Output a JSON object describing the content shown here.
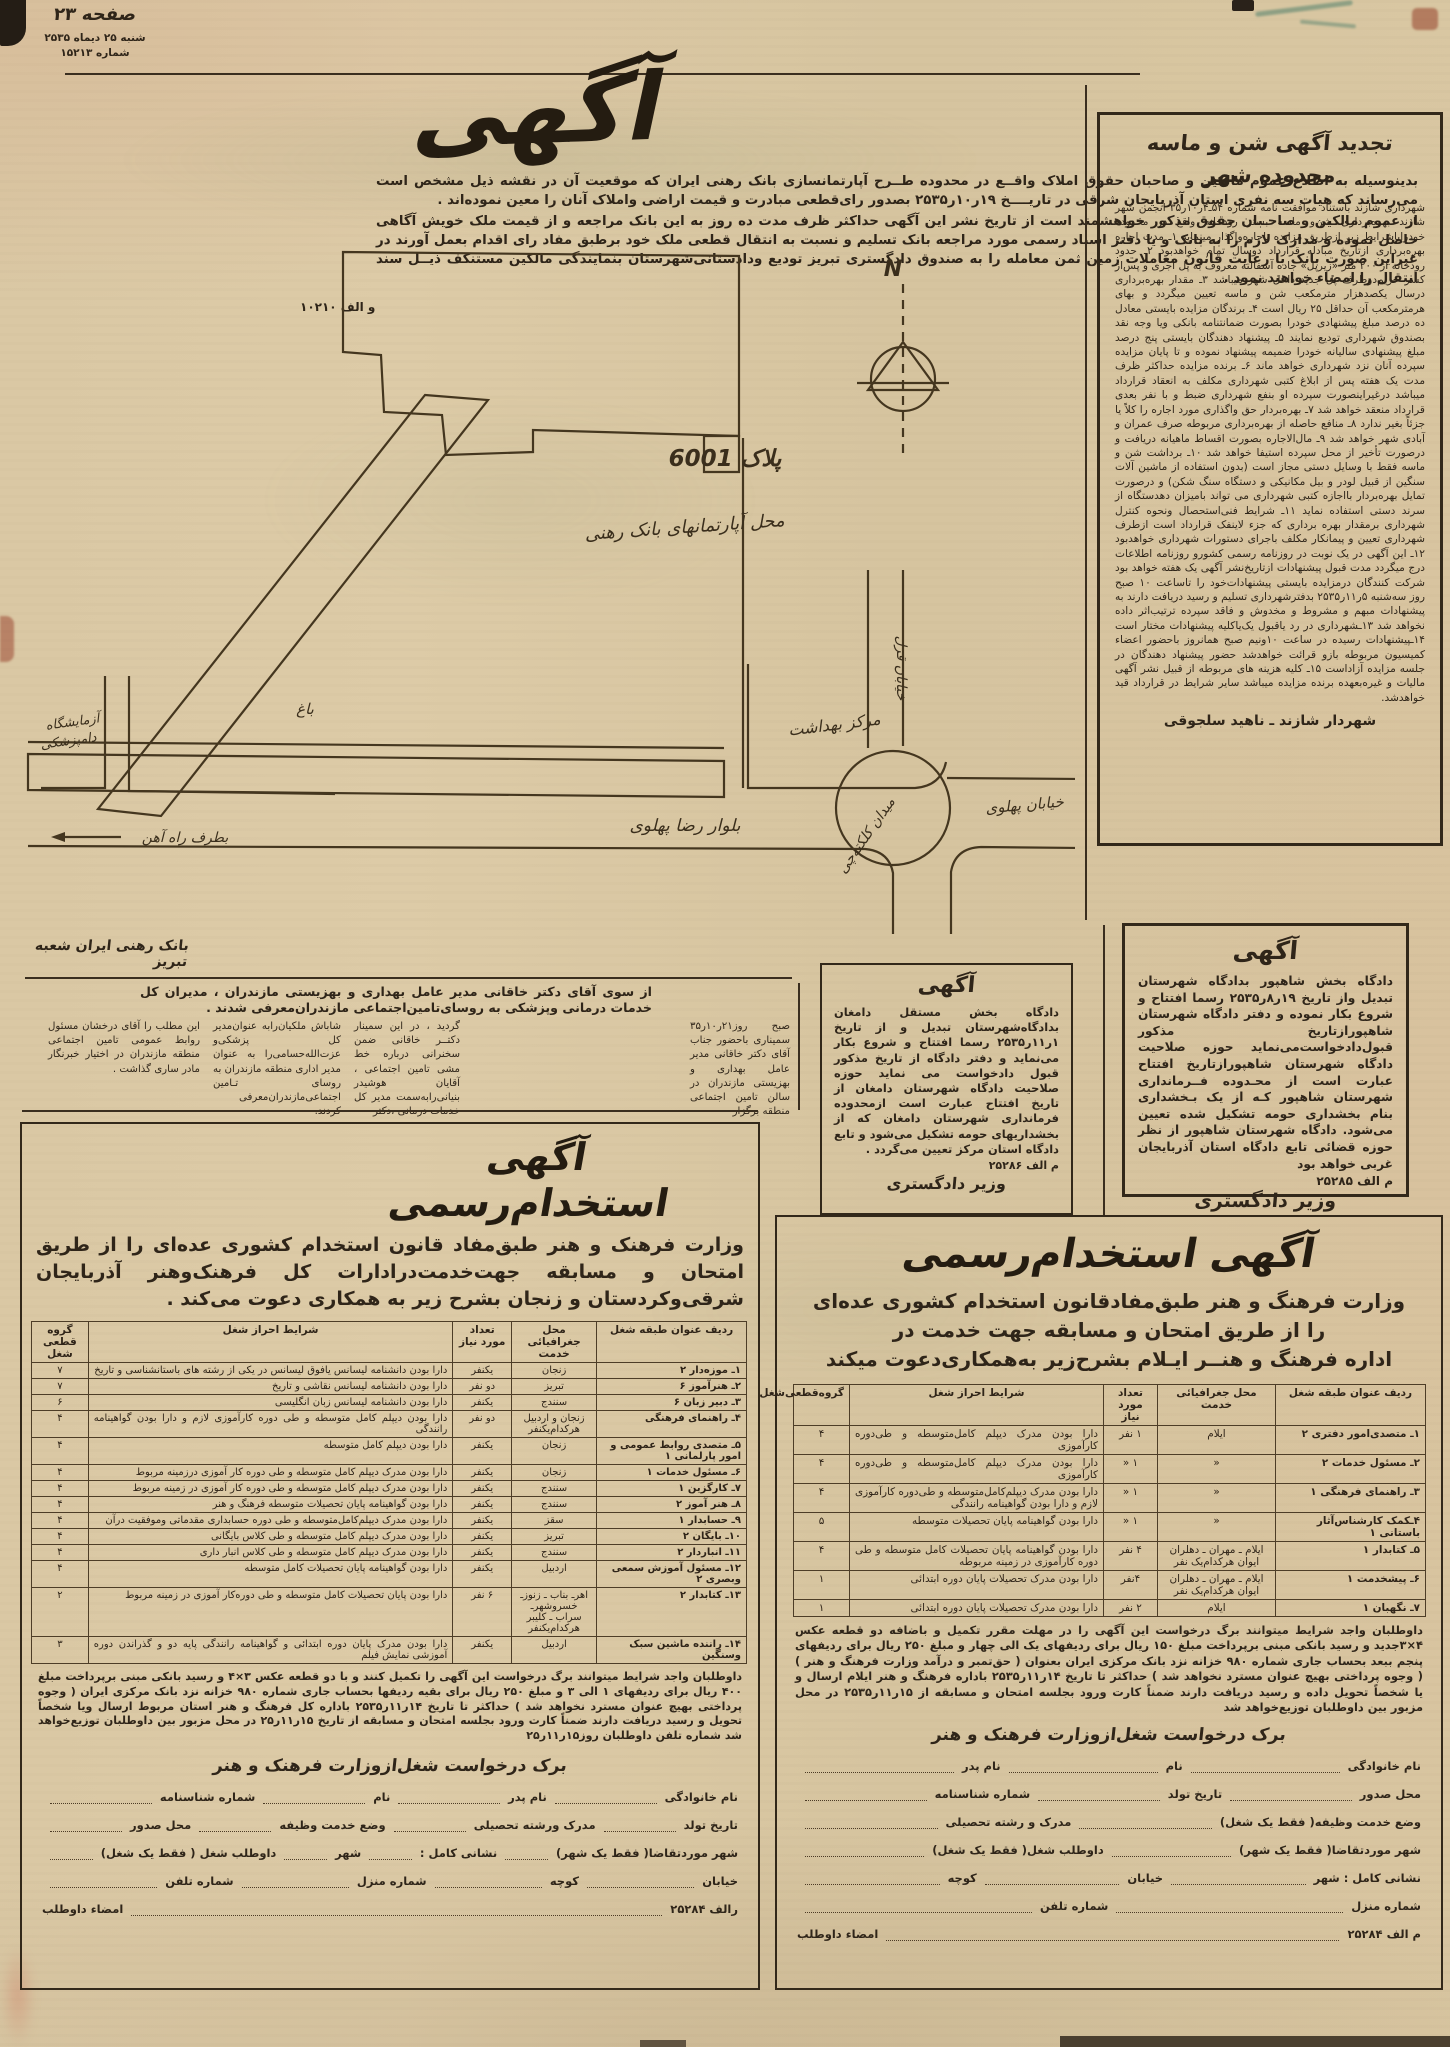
{
  "header": {
    "page_label": "صفحه ۲۳",
    "date": "شنبه ۲۵ دیماه ۲۵۳۵",
    "issue": "شماره ۱۵۲۱۳"
  },
  "main_notice": {
    "title": "آگهی",
    "para1": "بدینوسیله به اطلاع عموم مالکین و صاحبان حقوق املاک واقــع در محدوده طــرح آپارتمانسازی بانک رهنی ایران که موقعیت آن در نقشه ذیل مشخص است می‌رساند که هیات سه نفری استان آذربایجان شرقی در تاریــــخ ۱۹ر۱۰ر۲۵۳۵ بصدور رای‌قطعی مبادرت و قیمت اراضی واملاک آنان را معین نموده‌اند .",
    "para2": "از عموم مالکین و صاحـبان حقوق مذکور خواهشمند است از تاریخ نشر این آگهی حداکثر ظرف مدت ده روز به این بانک مراجعه و از قیمت ملک خویش آگاهی حاصل نموده و مدارک لازم را به بانک و یا دفتر اسناد رسمی مورد مراجعه بانک تسلیم و نسبت به انتقال قطعی ملک خود برطبق مفاد رای اقدام بعمل آورند در غیراین صورت بانک با رعایت قانون معاملات زمین ثمن معامله را به صندوق دادگستری تبریز تودیع ودادستانی‌شهرستان بنمایندگی مالکین مستنکف ذیــل سند انتقال را امضاء خواهند نمود .",
    "ref": "و الف ۱۰۲۱۰"
  },
  "bank_signature": "بانک رهنی ایران شعبه تبریز",
  "map": {
    "labels": {
      "north": "N",
      "plot": "پلاک 6001",
      "site": "محل آپارتمانهای بانک رهنی",
      "health_center": "مرکز بهداشت",
      "boulevard": "بلوار رضا پهلوی",
      "square": "میدان کلکته‌چی",
      "pahlavi_street": "خیابان پهلوی",
      "qezel_street": "خیابان قزل",
      "garden": "باغ",
      "lab_line1": "آزمایشگاه",
      "lab_line2": "دامپزشکی",
      "railway": "بطرف راه آهن"
    }
  },
  "sand_notice": {
    "title_line1": "تجدید آگهی شن و ماسه",
    "title_line2": "محدوده شهر",
    "body": "شهرداری شازند باستناد موافقت نامه شماره ۵۴ـ۴ر۱۰ر۳۵ انجمن شهر شازند بهره‌برداری شن‌و ماسه بستر رودخانه واقع در محدوده خودراباشرایط زیر ازطریق مزایده باجاره‌واگذار مینماید ۱ـ مدت اجاره بهره‌برداری ازتاریخ مبادله قرارداد دوسال تمام خواهدبود ۲ـ حدود رودخانه از ۲۰۰ متر «زیرپل» جاده آسفالته معروف به پل آجری و پس‌از کسر حریم‌دوطرف پل جدید داخل شهر میباشد ۳ـ مقدار بهره‌برداری درسال یکصدهزار مترمکعب شن و ماسه تعیین میگردد و بهای هرمترمکعب آن حداقل ۲۵ ریال است ۴ـ برندگان مزایده بایستی معادل ده درصد مبلغ پیشنهادی خودرا بصورت ضمانتنامه بانکی ویا وجه نقد بصندوق شهرداری تودیع نمایند ۵ـ پیشنهاد دهندگان بایستی پنج درصد مبلغ پیشنهادی سالیانه خودرا ضمیمه پیشنهاد نموده و تا پایان مزایده سپرده آنان نزد شهرداری خواهد ماند ۶ـ برنده مزایده حداکثر ظرف مدت یک هفته پس از ابلاغ کتبی شهرداری مکلف به انعقاد قرارداد میباشد درغیراینصورت سپرده او بنفع شهرداری ضبط و با نفر بعدی قرارداد منعقد خواهد شد ۷ـ بهره‌بردار حق واگذاری مورد اجاره را کلاً یا جزئاً بغیر ندارد ۸ـ منافع حاصله از بهره‌برداری مربوطه صرف عمران و آبادی شهر خواهد شد ۹ـ مال‌الاجاره بصورت اقساط ماهیانه دریافت و درصورت تأخیر از محل سپرده استیفا خواهد شد ۱۰ـ برداشت شن و ماسه فقط با وسایل دستی مجاز است (بدون استفاده از ماشین آلات سنگین از قبیل لودر و بیل مکانیکی و دستگاه سنگ شکن) و درصورت تمایل بهره‌بردار بااجازه کتبی شهرداری می تواند بامیزان دهدستگاه از سرند دستی استفاده نماید ۱۱ـ شرایط فنی‌استحصال ونحوه کنترل شهرداری برمقدار بهره برداری که جزء لاینفک قرارداد است ازطرف شهرداری تعیین و پیمانکار مکلف باجرای دستورات شهرداری خواهدبود ۱۲ـ این آگهی در یک نوبت در روزنامه رسمی کشورو روزنامه اطلاعات درج میگردد مدت قبول پیشنهادات ازتاریخ‌نشر آگهی یک هفته خواهد بود شرکت کنندگان درمزایده بایستی پیشنهادات‌خود را تاساعت ۱۰ صبح روز سه‌شنبه ۵ر۱۱ر۲۵۳۵ بدفترشهرداری تسلیم و رسید دریافت دارند به پیشنهادات مبهم و مشروط و مخدوش و فاقد سپرده ترتیب‌اثر داده نخواهد شد ۱۳ـشهرداری در رد یاقبول یک‌یاکلیه پیشنهادات مختار است ۱۴ـپیشنهادات رسیده در ساعت ۱۰ونیم صبح همانروز باحضور اعضاء کمیسیون مربوطه بازو قرائت خواهدشد حضور پیشنهاد دهندگان در جلسه مزایده آزاداست ۱۵ـ کلیه هزینه های مربوطه از قبیل نشر آگهی مالیات و غیره‌بعهده برنده مزایده میباشد سایر شرایط در قرارداد قید خواهدشد.",
    "signature": "شهردار شازند ـ ناهید سلجوقی"
  },
  "damghan_notice": {
    "title": "آگهی",
    "body": "دادگاه بخش مستقل دامغان بدادگاه‌شهرستان تبدیل و از تاریخ ۱ر۱۱ر۲۵۳۵ رسما افتتاح و شروع بکار می‌نماید و دفتر دادگاه از تاریخ مذکور قبول دادخواست می نماید حوزه صلاحیت دادگاه شهرستان دامغان از تاریخ افتتاح عبارت است ازمحدوده فرمانداری شهرستان دامغان که از بخشداریهای حومه تشکیل می‌شود و تابع دادگاه استان مرکز تعیین می‌گردد .",
    "ref": "م الف ۲۵۲۸۶",
    "signature": "وزیر دادگستری"
  },
  "shahpour_notice": {
    "title": "آگهی",
    "body": "دادگاه بخش شاهپور بدادگاه شهرستان تبدیل واز تاریخ ۱۹ر۸ر۲۵۳۵ رسما افتتاح و شروع بکار نموده و دفتر دادگاه شهرستان شاهپورازتاریخ مذکور قبول‌دادخواست‌می‌نماید حوزه صلاحیت دادگاه شهرستان شاهپورازتاریخ افتتاح عبارت است از محـدوده فــرمانداری شهرستان شاهپور کـه از یک بـخشداری بنام بخشداری حومه تشکیل شده تعیین می‌شود. دادگاه شهرستان شاهپور از نظر حوزه قضائی تابع دادگاه استان آذربایجان غربی خواهد بود",
    "ref": "م الف ۲۵۲۸۵",
    "signature": "وزیر دادگستری"
  },
  "seminar": {
    "intro": "از سوی آقای دکتر خاقانی مدیر عامل بهداری و بهزیستی مازندران ، مدیران کل خدمات درمانی وپزشکی به روسای‌تامین‌اجتماعی مازندران‌معرفی شدند .",
    "col1": "صبح روز۲۱ر۱۰ر۳۵ سمیناری باحضور جناب آقای دکتر خاقانی مدیر عامل بهداری و بهزیستی مازندران در سالن تامین اجتماعی منطقه برگزار",
    "col2": "گردید ، در این سمینار دکتــر خاقانی ضمن سخنرانی درباره خط مشی تامین اجتماعی ، آقایان هوشیدر بنیانی‌رابه‌سمت مدیر کل خدمات درمانی ،دکتر",
    "col3": "شاباش ملکیان‌رابه عنوان‌مدیر کل پزشکی‌و عزت‌الله‌حسامی‌را به عنوان مدیر اداری منطقه مازندران به روسای تـامین اجتماعی‌مازندران‌معرفی کردند.",
    "col4": "این مطلب را آقای درخشان مسئول روابط عمومی تامین اجتماعی منطقه مازندران در اختیار خبرنگار مادر ساری گذاشت ."
  },
  "left_ad": {
    "header": "آگهی استخدام‌رسمی",
    "intro": "وزارت فرهنک و هنر طبق‌مفاد قانون استخدام کشوری عده‌ای را از طریق امتحان و مسابقه جهت‌خدمت‌درادارات کل فرهنک‌وهنر آذربایجان شرقی‌وکردستان و زنجان بشرح زیر به همکاری دعوت می‌کند .",
    "table": {
      "headers": [
        "ردیف عنوان طبقه شغل",
        "محل جغرافیائی خدمت",
        "تعداد مورد نیاز",
        "شرایط احراز شغل",
        "گروه قطعی شغل"
      ],
      "rows": [
        {
          "t": "۱ـ موزه‌دار ۲",
          "p": "زنجان",
          "n": "یکنفر",
          "r": "دارا بودن دانشنامه لیسانس یافوق لیسانس در یکی از رشته های باستانشناسی و تاریخ",
          "g": "۷"
        },
        {
          "t": "۲ـ هنرآموز ۶",
          "p": "تبریز",
          "n": "دو نفر",
          "r": "دارا بودن دانشنامه لیسانس نقاشی و تاریخ",
          "g": "۷"
        },
        {
          "t": "۳ـ دبیر زبان ۶",
          "p": "سنندج",
          "n": "یکنفر",
          "r": "دارا بودن دانشنامه لیسانس زبان انگلیسی",
          "g": "۶"
        },
        {
          "t": "۴ـ راهنمای فرهنگی",
          "p": "زنجان و اردبیل هرکدام‌یکنفر",
          "n": "دو نفر",
          "r": "دارا بودن دیپلم کامل متوسطه و طی دوره کارآموزی لازم و دارا بودن گواهینامه رانندگی",
          "g": "۴"
        },
        {
          "t": "۵ـ متصدی روابط عمومی و امور پارلمانی ۱",
          "p": "زنجان",
          "n": "یکنفر",
          "r": "دارا بودن دیپلم کامل متوسطه",
          "g": "۴"
        },
        {
          "t": "۶ـ مسئول خدمات ۱",
          "p": "زنجان",
          "n": "یکنفر",
          "r": "دارا بودن مدرک دیپلم کامل متوسطه و طی دوره کار آموزی درزمینه مربوط",
          "g": "۴"
        },
        {
          "t": "۷ـ کارگزین ۱",
          "p": "سنندج",
          "n": "یکنفر",
          "r": "دارا بودن مدرک دیپلم کامل متوسطه و طی دوره کار آموزی در زمینه مربوط",
          "g": "۴"
        },
        {
          "t": "۸ـ هنر آموز ۲",
          "p": "سنندج",
          "n": "یکنفر",
          "r": "دارا بودن گواهینامه پایان تحصیلات متوسطه فرهنگ و هنر",
          "g": "۴"
        },
        {
          "t": "۹ـ حسابدار ۱",
          "p": "سقز",
          "n": "یکنفر",
          "r": "دارا بودن مدرک دیپلم‌کامل‌متوسطه و طی دوره حسابداری مقدماتی وموفقیت درآن",
          "g": "۴"
        },
        {
          "t": "۱۰ـ بایگان ۲",
          "p": "تبریز",
          "n": "یکنفر",
          "r": "دارا بودن مدرک دیپلم کامل متوسطه و طی کلاس بایگانی",
          "g": "۴"
        },
        {
          "t": "۱۱ـ انباردار ۲",
          "p": "سنندج",
          "n": "یکنفر",
          "r": "دارا بودن مدرک دیپلم کامل متوسطه و طی کلاس انبار داری",
          "g": "۴"
        },
        {
          "t": "۱۲ـ مسئول آموزش سمعی وبصری ۲",
          "p": "اردبیل",
          "n": "یکنفر",
          "r": "دارا بودن گواهینامه پایان تحصیلات کامل متوسطه",
          "g": "۴"
        },
        {
          "t": "۱۳ـ کتابدار ۲",
          "p": "اهرـ بناب ـ زنوزـ خسروشهرـ سراب ـ کلیبر هرکدام‌یکنفر",
          "n": "۶ نفر",
          "r": "دارا بودن پایان تحصیلات کامل متوسطه و طی دوره‌کار آموزی در زمینه مربوط",
          "g": "۲"
        },
        {
          "t": "۱۴ـ راننده ماشین سبک وسنگین",
          "p": "اردبیل",
          "n": "یکنفر",
          "r": "دارا بودن مدرک پایان دوره ابتدائی و گواهینامه رانندگی پایه دو و گذراندن دوره آموزشی نمایش فیلم",
          "g": "۳"
        }
      ]
    },
    "note": "داوطلبان واجد شرایط میتوانند برگ درخواست این آگهی را تکمیل کنند و با دو قطعه عکس ۳×۴ و رسید بانکی مبنی برپرداخت مبلغ ۴۰۰ ریال برای ردیفهای ۱ الی ۳ و مبلغ ۲۵۰ ریال برای بقیه ردیفها بحساب جاری شماره ۹۸۰ خزانه نزد بانک مرکزی ایران ( وجوه پرداختی بهیچ عنوان مسترد نخواهد شد ) حداکثر تا تاریخ ۱۴ر۱۱ر۲۵۳۵ باداره کل فرهنگ و هنر استان مربوط ارسال ویا شخصاً تحویل و رسید دریافت دارند ضمناً کارت ورود بجلسه امتحان و مسابقه از تاریخ ۱۵ر۱۱ر۲۵ در محل مزبور بین داوطلبان توزیع‌خواهد شد     شماره تلفن داوطلبان روز۱۵ر۱۱ر۲۵",
    "form_title": "برک درخواست شغل‌ازوزارت فرهنک و هنر",
    "form": {
      "rows": [
        [
          "نام خانوادگی",
          "نام پدر",
          "نام",
          "شماره شناسنامه"
        ],
        [
          "تاریخ تولد",
          "مدرک ورشته تحصیلی",
          "وضع خدمت وظیفه",
          "محل صدور"
        ],
        [
          "شهر موردتقاضا( فقط یک شهر)",
          "نشانی کامل :",
          "شهر",
          "داوطلب شغل ( فقط یک شغل)"
        ],
        [
          "خیابان",
          "کوچه",
          "شماره منزل",
          "شماره تلفن"
        ],
        [
          "رالف ۲۵۲۸۴",
          "امضاء داوطلب"
        ]
      ]
    }
  },
  "right_ad": {
    "header": "آگهی استخدام‌رسمی",
    "intro1": "وزارت فرهنگ و هنر طبق‌مفادقانون استخدام کشوری عده‌ای",
    "intro2": "را از طریق امتحان و مسابقه جهت خدمت در",
    "intro3": "اداره فرهنگ و هنــر ایـلام بشرح‌زیر به‌همکاری‌دعوت میکند",
    "table": {
      "headers": [
        "ردیف عنوان طبقه شغل",
        "محل جغرافیائی خدمت",
        "تعداد مورد نیاز",
        "شرایط احراز شغل",
        "گروه‌قطعی‌شغل"
      ],
      "rows": [
        {
          "t": "۱ـ متصدی‌امور دفتری ۲",
          "p": "ایلام",
          "n": "۱ نفر",
          "r": "دارا بودن مدرک دیپلم کامل‌متوسطه و طی‌دوره کارآموزی",
          "g": "۴"
        },
        {
          "t": "۲ـ مسئول خدمات ۲",
          "p": "«",
          "n": "۱ «",
          "r": "دارا بودن مدرک دیپلم کامل‌متوسطه و طی‌دوره کارآموزی",
          "g": "۴"
        },
        {
          "t": "۳ـ راهنمای فرهنگی ۱",
          "p": "«",
          "n": "۱ «",
          "r": "دارا بودن مدرک دیپلم‌کامل‌متوسطه و طی‌دوره کارآموزی لازم و دارا بودن گواهینامه رانندگی",
          "g": "۴"
        },
        {
          "t": "۴ـکمک کارشناس‌آثار باستانی ۱",
          "p": "«",
          "n": "۱ «",
          "r": "دارا بودن گواهینامه پایان تحصیلات متوسطه",
          "g": "۵"
        },
        {
          "t": "۵ـ کتابدار ۱",
          "p": "ایلام ـ مهران ـ دهلران ایوان هرکدام‌یک نفر",
          "n": "۴ نفر",
          "r": "دارا بودن گواهینامه پایان تحصیلات کامل متوسطه و طی دوره کارآموزی در زمینه مربوطه",
          "g": "۴"
        },
        {
          "t": "۶ـ پیشخدمت ۱",
          "p": "ایلام ـ مهران ـ دهلران ایوان هرکدام‌یک نفر",
          "n": "۴نفر",
          "r": "دارا بودن مدرک تحصیلات پایان دوره ابتدائی",
          "g": "۱"
        },
        {
          "t": "۷ـ نگهبان ۱",
          "p": "ایلام",
          "n": "۲ نفر",
          "r": "دارا بودن مدرک تحصیلات پایان دوره ابتدائی",
          "g": "۱"
        }
      ]
    },
    "note": "داوطلبان واجد شرایط میتوانند برگ درخواست این آگهی را در مهلت مقرر تکمیل و باضافه دو قطعه عکس ۴×۳جدید و رسید بانکی مبنی برپرداخت مبلغ ۱۵۰ ریال برای ردیفهای یک الی چهار و مبلغ ۲۵۰ ریال برای ردیفهای پنجم ببعد بحساب جاری شماره ۹۸۰ خزانه نزد بانک مرکزی ایران بعنوان ( حق‌تمبر و درآمد وزارت فرهنگ و هنر ) ( وجوه پرداختی بهیچ عنوان مسترد نخواهد شد ) حداکثر تا تاریخ ۱۴ر۱۱ر۲۵۳۵ باداره فرهنگ و هنر ایلام ارسال و یا شخصاً تحویل داده و رسید دریافت دارند ضمناً کارت ورود بجلسه امتحان و مسابقه از ۱۵ر۱۱ر۲۵۳۵ در محل مزبور بین داوطلبان توزیع‌خواهد شد",
    "form_title": "برک درخواست شغل‌ازوزارت فرهنک و هنر",
    "form": {
      "rows": [
        [
          "نام خانوادگی",
          "نام",
          "نام پدر"
        ],
        [
          "محل صدور",
          "تاریخ تولد",
          "شماره شناسنامه"
        ],
        [
          "وضع خدمت وظیفه( فقط یک شغل)",
          "مدرک و رشته تحصیلی"
        ],
        [
          "شهر موردتقاضا( فقط یک شهر)",
          "داوطلب شغل( فقط یک شغل)"
        ],
        [
          "نشانی کامل : شهر",
          "خیابان",
          "کوچه"
        ],
        [
          "شماره منزل",
          "شماره تلفن"
        ],
        [
          "م الف ۲۵۲۸۴",
          "امضاء داوطلب"
        ]
      ]
    }
  }
}
